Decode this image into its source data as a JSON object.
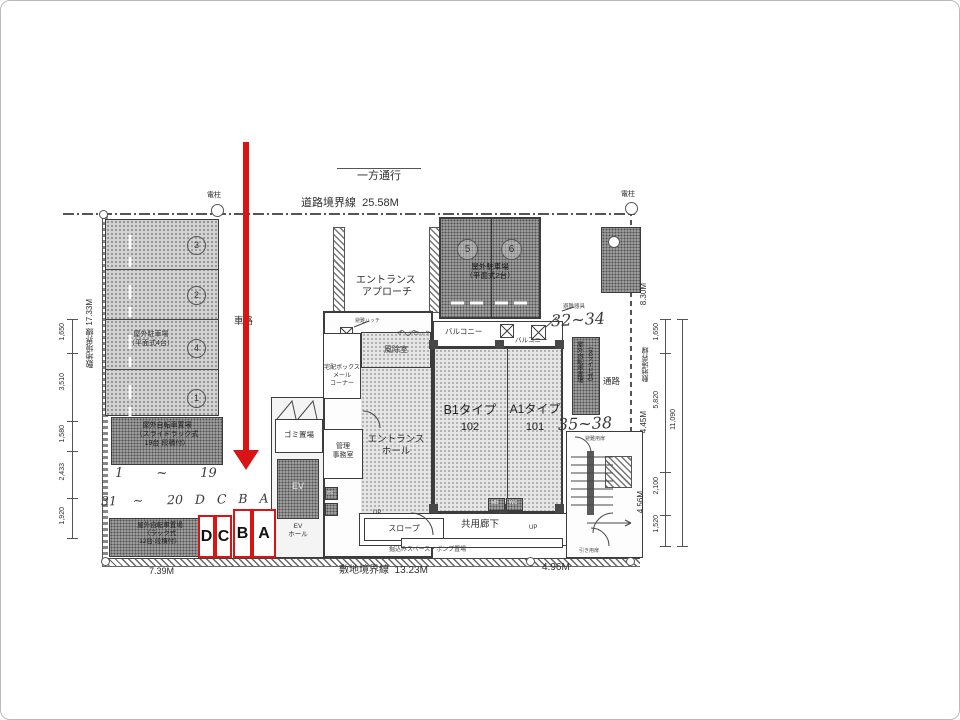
{
  "colors": {
    "highlight": "#d81414",
    "ink": "#3c3c3c"
  },
  "top": {
    "one_way": "一方通行",
    "road_boundary": "道路境界線  25.58M",
    "pole_left": "電柱",
    "pole_right": "電柱"
  },
  "left": {
    "site_boundary": "敷地境界線 17.33M",
    "dims": [
      "1,650",
      "3,510",
      "1,580",
      "2,433",
      "1,920"
    ],
    "flat_parking": {
      "line1": "屋外駐車場",
      "line2": "（平面式4台）",
      "stall_numbers": [
        "3",
        "2",
        "4",
        "1"
      ]
    },
    "bike_slide": {
      "line1": "屋外自転車置場",
      "line2": "（スライドラック式",
      "line3": "19台 段積付）",
      "handwritten_range": "1        ~        19"
    },
    "handwritten_row": "31    ~      20   D   C   B   A",
    "bike_rack": {
      "line1": "屋外自転車置場",
      "line2": "（ラック式",
      "line3": "12台 段積付）"
    },
    "driveway": "車路",
    "dim_bottom": "7.39M"
  },
  "highlight_stalls": [
    "D",
    "C",
    "B",
    "A"
  ],
  "center": {
    "entrance_approach_1": "エントランス",
    "entrance_approach_2": "アプローチ",
    "flat_parking2": {
      "line1": "屋外駐車場",
      "line2": "（平面式2台）",
      "stall_numbers": [
        "5",
        "6"
      ]
    },
    "hatch_label": "避難ハッチ",
    "windbreak": "風除室",
    "autolock": "オートロック",
    "mail1": "宅配ボックス",
    "mail2": "メール",
    "mail3": "コーナー",
    "entrance_hall_1": "エントランス",
    "entrance_hall_2": "ホール",
    "office1": "管理",
    "office2": "事務室",
    "trash": "ゴミ置場",
    "elevator": "EV",
    "ev_hall_1": "EV",
    "ev_hall_2": "ホール",
    "ps": "PS",
    "slope": "スロープ",
    "corridor": "共用廊下",
    "mb": "MB",
    "wc": "WC",
    "up1": "UP",
    "up2": "UP",
    "up3": "UP",
    "pump_note": "掘込みスペース・ポンプ置場",
    "balcony_left": "バルコニー",
    "balcony_right": "バルコニー",
    "unit_b": {
      "type": "B1タイプ",
      "number": "102"
    },
    "unit_a": {
      "type": "A1タイプ",
      "number": "101"
    }
  },
  "right": {
    "handwritten_32_34": "32~34",
    "handwritten_35_38": "35~38",
    "equipment_label": "避難器具",
    "bike_slide2_1": "屋外自転車置場",
    "bike_slide2_2": "（スライド式）",
    "passage": "通路",
    "door_top": "避難用扉",
    "door_bottom": "引き用扉",
    "dim_830": "8.30M",
    "site_boundary": "敷地境界線",
    "dim_445": "4.45M",
    "dim_456": "4.56M",
    "dims_inner": [
      "1,650",
      "5,820",
      "2,100",
      "1,520"
    ],
    "dim_total": "11,090"
  },
  "bottom": {
    "site_boundary_1323": "敷地境界線  13.23M",
    "dim_496": "4.96M"
  }
}
